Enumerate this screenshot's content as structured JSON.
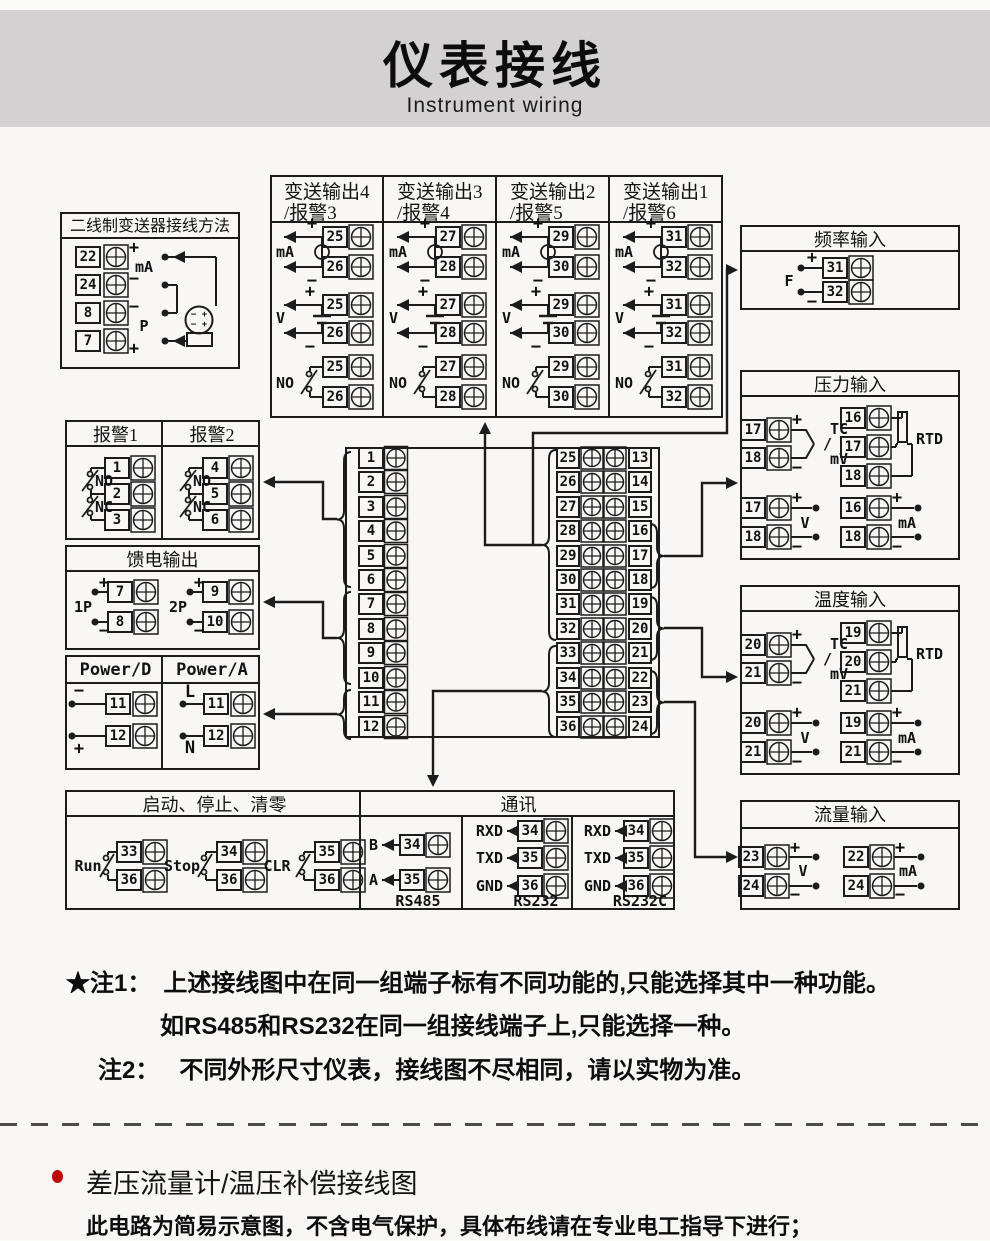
{
  "header": {
    "title": "仪表接线",
    "subtitle": "Instrument wiring"
  },
  "sym": {
    "plus": "+",
    "minus": "−"
  },
  "two_wire": {
    "title": "二线制变送器接线方法",
    "terminals": [
      "22",
      "24",
      "8",
      "7"
    ],
    "signs": [
      "+",
      "−",
      "−",
      "+"
    ],
    "ma_label": "mA",
    "p_label": "P"
  },
  "xmit": {
    "cols": [
      {
        "title1": "变送输出4",
        "title2": "/报警3",
        "terminals": [
          "25",
          "26"
        ]
      },
      {
        "title1": "变送输出3",
        "title2": "/报警4",
        "terminals": [
          "27",
          "28"
        ]
      },
      {
        "title1": "变送输出2",
        "title2": "/报警5",
        "terminals": [
          "29",
          "30"
        ]
      },
      {
        "title1": "变送输出1",
        "title2": "/报警6",
        "terminals": [
          "31",
          "32"
        ]
      }
    ],
    "ma_label": "mA",
    "v_label": "V",
    "no_label": "NO"
  },
  "freq": {
    "title": "频率输入",
    "f_label": "F",
    "terminals": [
      "31",
      "32"
    ]
  },
  "alarms": {
    "cols": [
      {
        "title": "报警1",
        "terminals": [
          "1",
          "2",
          "3"
        ]
      },
      {
        "title": "报警2",
        "terminals": [
          "4",
          "5",
          "6"
        ]
      }
    ],
    "no_label": "NO",
    "nc_label": "NC"
  },
  "feed": {
    "title": "馈电输出",
    "groups": [
      {
        "label": "1P",
        "terminals": [
          "7",
          "8"
        ],
        "signs": [
          "+",
          "−"
        ]
      },
      {
        "label": "2P",
        "terminals": [
          "9",
          "10"
        ],
        "signs": [
          "+",
          "−"
        ]
      }
    ]
  },
  "power": {
    "cols": [
      {
        "title": "Power/D",
        "rows": [
          {
            "sign": "−",
            "n": "11"
          },
          {
            "sign": "+",
            "n": "12"
          }
        ]
      },
      {
        "title": "Power/A",
        "rows": [
          {
            "sign": "L",
            "n": "11"
          },
          {
            "sign": "N",
            "n": "12"
          }
        ]
      }
    ]
  },
  "center": {
    "left": [
      "1",
      "2",
      "3",
      "4",
      "5",
      "6",
      "7",
      "8",
      "9",
      "10",
      "11",
      "12"
    ],
    "right_inner": [
      "25",
      "26",
      "27",
      "28",
      "29",
      "30",
      "31",
      "32",
      "33",
      "34",
      "35",
      "36"
    ],
    "right_outer": [
      "13",
      "14",
      "15",
      "16",
      "17",
      "18",
      "19",
      "20",
      "21",
      "22",
      "23",
      "24"
    ]
  },
  "pressure": {
    "title": "压力输入",
    "tc": {
      "terminals": [
        "17",
        "18"
      ],
      "l1": "TC",
      "l2": "/",
      "l3": "mV"
    },
    "rtd": {
      "terminals": [
        "16",
        "17",
        "18"
      ],
      "label": "RTD"
    },
    "volt": {
      "terminals": [
        "17",
        "18"
      ],
      "label": "V"
    },
    "curr": {
      "terminals": [
        "16",
        "18"
      ],
      "label": "mA"
    }
  },
  "temp": {
    "title": "温度输入",
    "tc": {
      "terminals": [
        "20",
        "21"
      ],
      "l1": "TC",
      "l2": "/",
      "l3": "mV"
    },
    "rtd": {
      "terminals": [
        "19",
        "20",
        "21"
      ],
      "label": "RTD"
    },
    "volt": {
      "terminals": [
        "20",
        "21"
      ],
      "label": "V"
    },
    "curr": {
      "terminals": [
        "19",
        "21"
      ],
      "label": "mA"
    }
  },
  "flow": {
    "title": "流量输入",
    "volt": {
      "terminals": [
        "23",
        "24"
      ],
      "label": "V"
    },
    "curr": {
      "terminals": [
        "22",
        "24"
      ],
      "label": "mA"
    }
  },
  "runstop": {
    "title": "启动、停止、清零",
    "switches": [
      {
        "label": "Run",
        "terminals": [
          "33",
          "36"
        ]
      },
      {
        "label": "Stop",
        "terminals": [
          "34",
          "36"
        ]
      },
      {
        "label": "CLR",
        "terminals": [
          "35",
          "36"
        ]
      }
    ]
  },
  "comm": {
    "title": "通讯",
    "groups": [
      {
        "label": "RS485",
        "rows": [
          {
            "sig": "B",
            "n": "34"
          },
          {
            "sig": "A",
            "n": "35"
          }
        ]
      },
      {
        "label": "RS232",
        "rows": [
          {
            "sig": "RXD",
            "n": "34"
          },
          {
            "sig": "TXD",
            "n": "35"
          },
          {
            "sig": "GND",
            "n": "36"
          }
        ]
      },
      {
        "label": "RS232C",
        "rows": [
          {
            "sig": "RXD",
            "n": "34"
          },
          {
            "sig": "TXD",
            "n": "35"
          },
          {
            "sig": "GND",
            "n": "36"
          }
        ]
      }
    ]
  },
  "notes": {
    "n1_label": "★注1：",
    "n1_line1": "上述接线图中在同一组端子标有不同功能的,只能选择其中一种功能。",
    "n1_line2": "如RS485和RS232在同一组接线端子上,只能选择一种。",
    "n2_label": "注2：",
    "n2_text": "不同外形尺寸仪表，接线图不尽相同，请以实物为准。"
  },
  "section2": {
    "heading": "差压流量计/温压补偿接线图",
    "body": "此电路为简易示意图，不含电气保护，具体布线请在专业电工指导下进行；"
  },
  "colors": {
    "line": "#1c1c1c",
    "header_bg": "#d3d1d1",
    "page_bg": "#f8f7f5",
    "accent_red": "#c00000"
  }
}
